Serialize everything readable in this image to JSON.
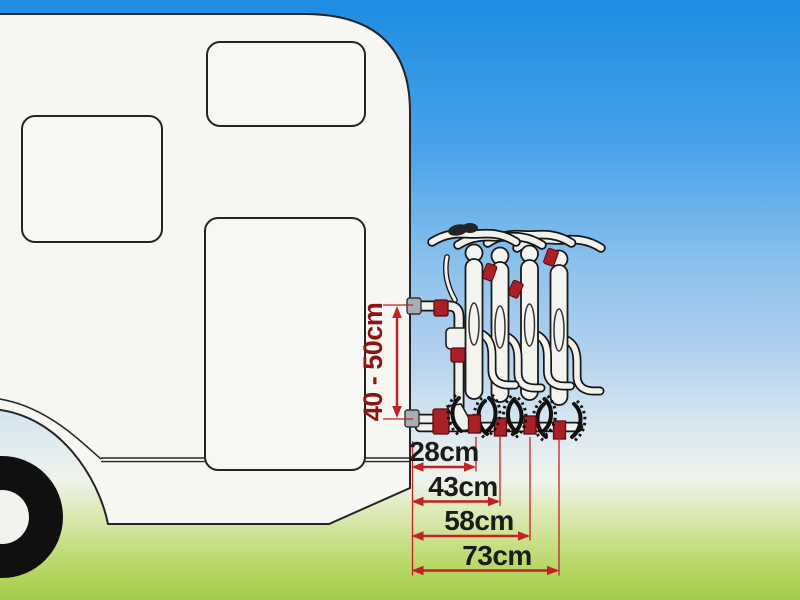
{
  "scene": {
    "elements": [
      "sky",
      "grass",
      "caravan",
      "caravan-windows",
      "caravan-wheel",
      "rear-bike-rack",
      "four-bicycles",
      "dimension-annotations"
    ]
  },
  "dimensions": {
    "vertical": {
      "label": "40 - 50cm",
      "min_cm": 40,
      "max_cm": 50
    },
    "horizontal": [
      {
        "label": "28cm",
        "cm": 28
      },
      {
        "label": "43cm",
        "cm": 43
      },
      {
        "label": "58cm",
        "cm": 58
      },
      {
        "label": "73cm",
        "cm": 73
      }
    ]
  },
  "colors": {
    "sky_top": "#1d8ce1",
    "sky_low": "#dde9f0",
    "grass_bottom": "#a3cb4b",
    "caravan_body": "#f6f6f3",
    "line_outline": "#242424",
    "dimension_arrow_red": "#c32222",
    "vertical_label_red": "#8c1414",
    "horizontal_label_black": "#1b1b1b",
    "rack_accent_red": "#a92026",
    "wall_pad_gray": "#a7adb3"
  }
}
